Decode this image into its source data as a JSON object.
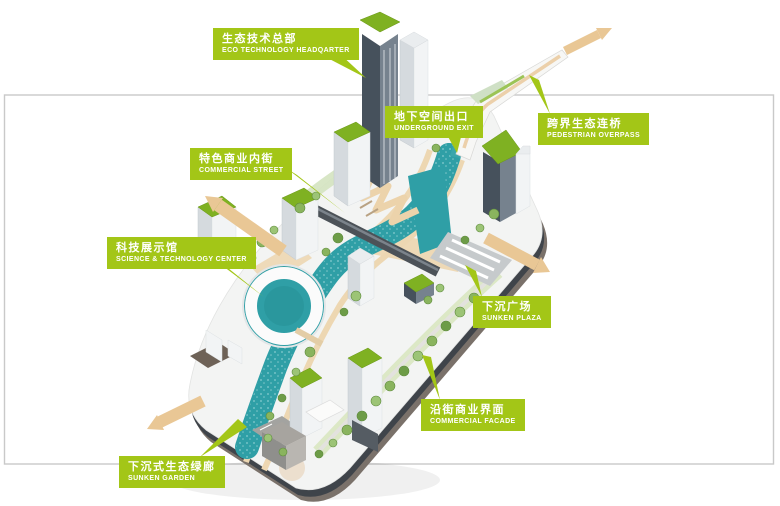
{
  "colors": {
    "label_green": "#a3c617",
    "arrow_tan": "#e9c795",
    "water_teal": "#2f9fa6",
    "roof_green": "#7fb122",
    "frame_border": "#c9c9c9"
  },
  "labels": [
    {
      "id": "eco-technology-headquarter",
      "zh": "生态技术总部",
      "en": "ECO TECHNOLOGY  HEADQARTER"
    },
    {
      "id": "underground-exit",
      "zh": "地下空间出口",
      "en": "UNDERGROUND EXIT"
    },
    {
      "id": "pedestrian-overpass",
      "zh": "跨界生态连桥",
      "en": "PEDESTRIAN OVERPASS"
    },
    {
      "id": "commercial-street",
      "zh": "特色商业内街",
      "en": "COMMERCIAL STREET"
    },
    {
      "id": "science-technology-center",
      "zh": "科技展示馆",
      "en": "SCIENCE & TECHNOLOGY CENTER"
    },
    {
      "id": "sunken-plaza",
      "zh": "下沉广场",
      "en": "SUNKEN PLAZA"
    },
    {
      "id": "commercial-facade",
      "zh": "沿街商业界面",
      "en": "COMMERCIAL FACADE"
    },
    {
      "id": "sunken-garden",
      "zh": "下沉式生态绿廊",
      "en": "SUNKEN GARDEN"
    }
  ]
}
